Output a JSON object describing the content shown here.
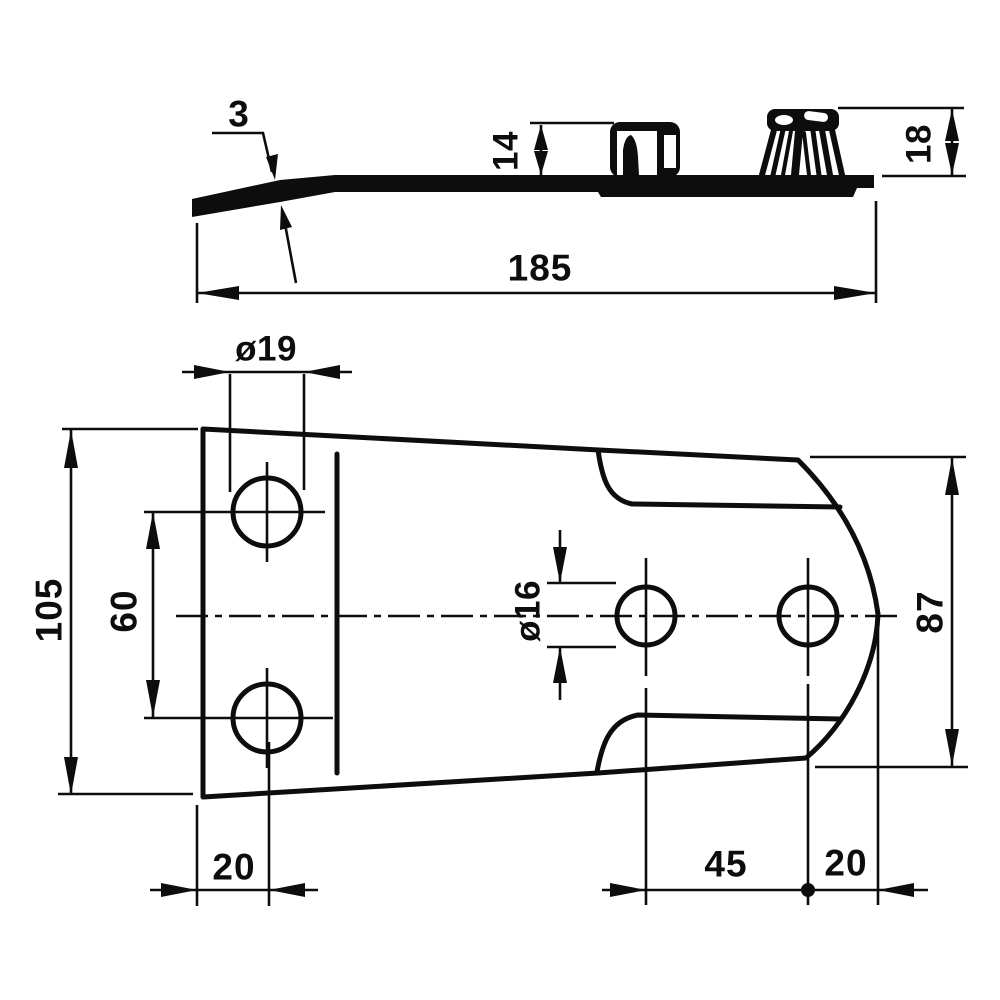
{
  "page": {
    "background": "#ffffff",
    "ink": "#0d0d0d",
    "description": "Two-view technical drawing of a mower skid / blade holder plate with dimensions in mm"
  },
  "views": {
    "side": {
      "name": "side-profile-view",
      "dims": {
        "blade_thickness": "3",
        "clamp_height": "14",
        "tail_height": "18",
        "overall_length": "185"
      }
    },
    "plan": {
      "name": "plan-view",
      "dims": {
        "large_hole_diameter": "ø19",
        "left_width": "105",
        "large_hole_spacing": "60",
        "small_hole_diameter": "ø16",
        "right_width": "87",
        "left_edge_to_hole": "20",
        "small_hole_spacing": "45",
        "hole_to_right_edge": "20"
      }
    }
  }
}
